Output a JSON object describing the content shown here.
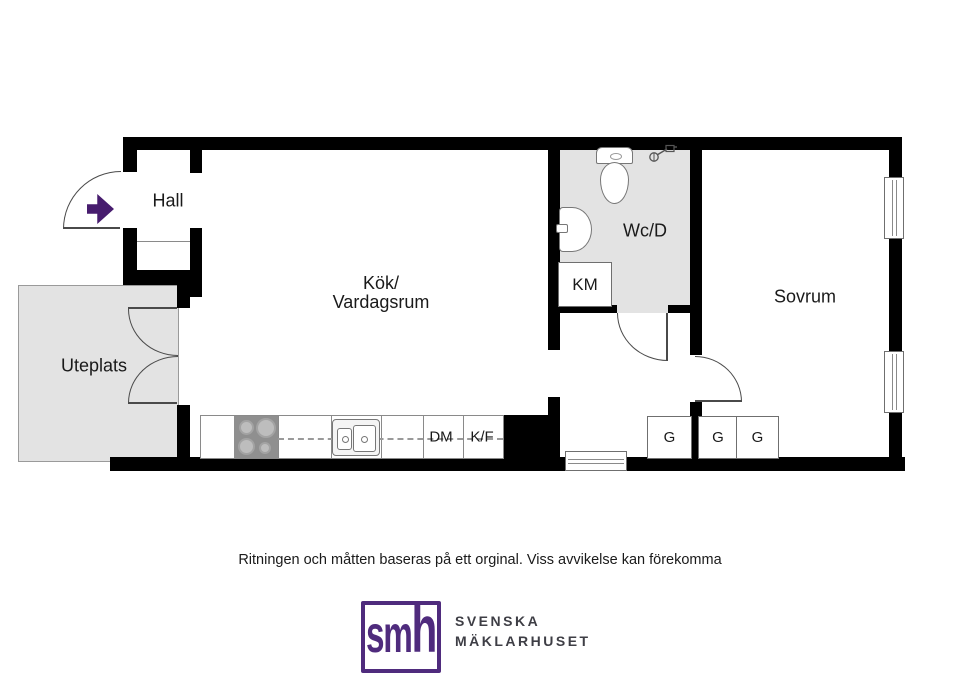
{
  "plan": {
    "rooms": {
      "hall": "Hall",
      "kitchen_line1": "Kök/",
      "kitchen_line2": "Vardagsrum",
      "patio": "Uteplats",
      "bathroom": "Wc/D",
      "bedroom": "Sovrum"
    },
    "appliances": {
      "washing_machine": "KM",
      "dishwasher": "DM",
      "fridge_freezer": "K/F"
    },
    "wardrobes": [
      "G",
      "G",
      "G"
    ],
    "icons": [
      "entrance-arrow-icon",
      "door-swing-arc",
      "toilet-icon",
      "bathroom-sink-icon",
      "shower-mixer-icon",
      "stove-icon",
      "kitchen-sink-icon",
      "window-icon"
    ]
  },
  "footer": {
    "disclaimer": "Ritningen och måtten baseras på ett orginal. Viss avvikelse kan förekomma"
  },
  "logo": {
    "monogram_sm": "sm",
    "monogram_h": "h",
    "name_line1": "SVENSKA",
    "name_line2": "MÄKLARHUSET"
  },
  "colors": {
    "accent_purple": "#4F2B7D",
    "arrow_purple": "#471C6E",
    "wall_black": "#000000",
    "room_gray": "#E3E3E3"
  }
}
